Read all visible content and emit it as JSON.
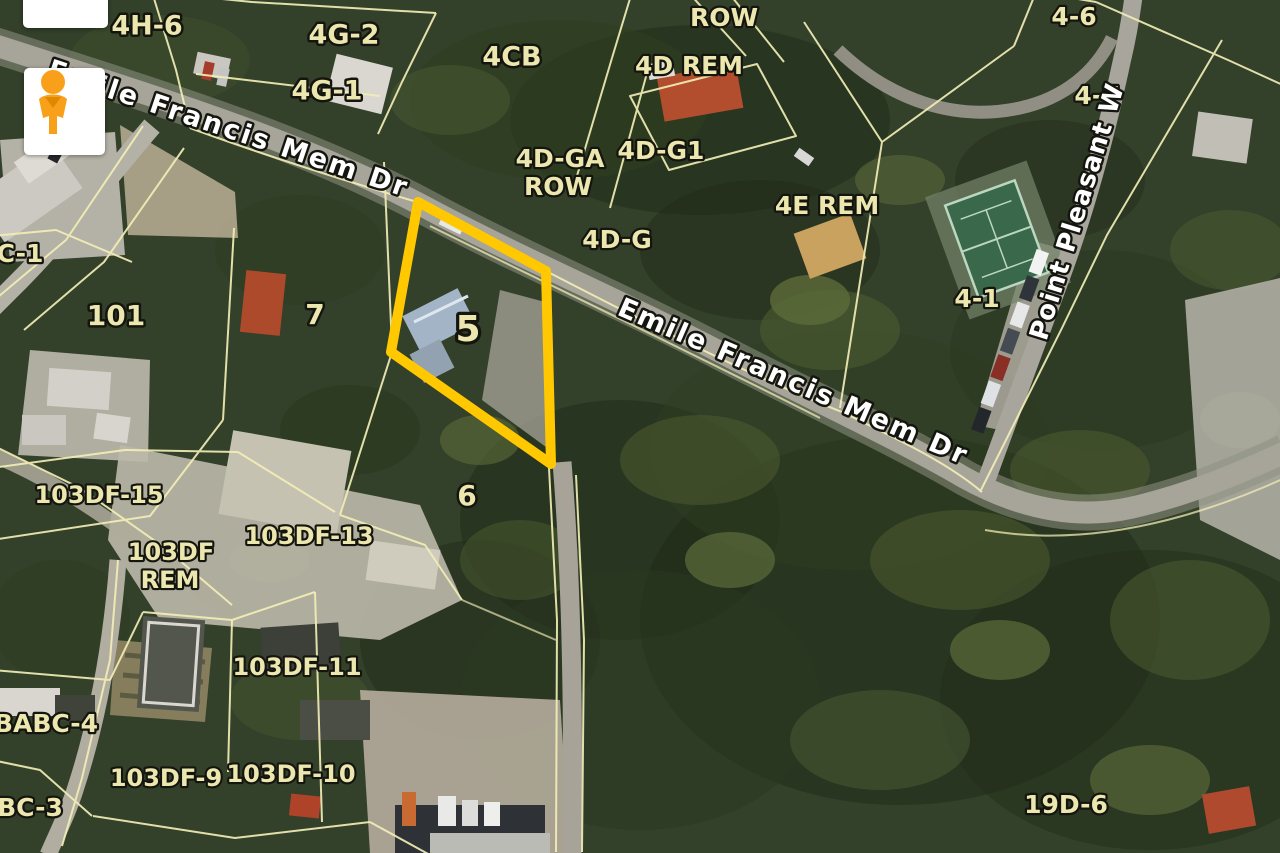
{
  "map": {
    "type": "aerial-parcel-map",
    "colors": {
      "parcel_line": "#f2eeb6",
      "parcel_label": "#ece7ae",
      "street_label": "#ffffff",
      "highlight": "#ffc800"
    },
    "highlight": {
      "parcel_id": "5",
      "vertices": [
        [
          418,
          202
        ],
        [
          546,
          271
        ],
        [
          551,
          464
        ],
        [
          391,
          352
        ]
      ],
      "stroke_width": 10
    },
    "labels": [
      {
        "text": "4H-6",
        "x": 147,
        "y": 27,
        "size": 27,
        "rot": 0,
        "kind": "parcel"
      },
      {
        "text": "4G-2",
        "x": 344,
        "y": 36,
        "size": 27,
        "rot": 0,
        "kind": "parcel"
      },
      {
        "text": "4G-1",
        "x": 327,
        "y": 92,
        "size": 27,
        "rot": 0,
        "kind": "parcel"
      },
      {
        "text": "4CB",
        "x": 512,
        "y": 58,
        "size": 27,
        "rot": 0,
        "kind": "parcel"
      },
      {
        "text": "ROW",
        "x": 724,
        "y": 19,
        "size": 25,
        "rot": 0,
        "kind": "parcel"
      },
      {
        "text": "4D REM",
        "x": 689,
        "y": 67,
        "size": 25,
        "rot": 0,
        "kind": "parcel"
      },
      {
        "text": "4D-GA",
        "x": 560,
        "y": 160,
        "size": 25,
        "rot": 0,
        "kind": "parcel"
      },
      {
        "text": "ROW",
        "x": 558,
        "y": 188,
        "size": 25,
        "rot": 0,
        "kind": "parcel"
      },
      {
        "text": "4D-G1",
        "x": 661,
        "y": 152,
        "size": 25,
        "rot": 0,
        "kind": "parcel"
      },
      {
        "text": "4D-G",
        "x": 617,
        "y": 241,
        "size": 25,
        "rot": 0,
        "kind": "parcel"
      },
      {
        "text": "4E REM",
        "x": 827,
        "y": 207,
        "size": 25,
        "rot": 0,
        "kind": "parcel"
      },
      {
        "text": "4-6",
        "x": 1074,
        "y": 18,
        "size": 25,
        "rot": 0,
        "kind": "parcel"
      },
      {
        "text": "4-7",
        "x": 1097,
        "y": 97,
        "size": 25,
        "rot": 0,
        "kind": "parcel"
      },
      {
        "text": "4-1",
        "x": 977,
        "y": 300,
        "size": 25,
        "rot": 0,
        "kind": "parcel"
      },
      {
        "text": "C-1",
        "x": 20,
        "y": 255,
        "size": 25,
        "rot": 0,
        "kind": "parcel"
      },
      {
        "text": "101",
        "x": 116,
        "y": 317,
        "size": 28,
        "rot": 0,
        "kind": "parcel"
      },
      {
        "text": "7",
        "x": 315,
        "y": 316,
        "size": 28,
        "rot": 0,
        "kind": "parcel"
      },
      {
        "text": "6",
        "x": 467,
        "y": 497,
        "size": 28,
        "rot": 0,
        "kind": "parcel"
      },
      {
        "text": "103DF-15",
        "x": 99,
        "y": 496,
        "size": 24,
        "rot": 0,
        "kind": "parcel"
      },
      {
        "text": "103DF",
        "x": 171,
        "y": 553,
        "size": 24,
        "rot": 0,
        "kind": "parcel"
      },
      {
        "text": "REM",
        "x": 170,
        "y": 581,
        "size": 24,
        "rot": 0,
        "kind": "parcel"
      },
      {
        "text": "103DF-13",
        "x": 309,
        "y": 537,
        "size": 24,
        "rot": 0,
        "kind": "parcel"
      },
      {
        "text": "103DF-11",
        "x": 297,
        "y": 668,
        "size": 24,
        "rot": 0,
        "kind": "parcel"
      },
      {
        "text": "BABC-4",
        "x": 46,
        "y": 725,
        "size": 25,
        "rot": 0,
        "kind": "parcel"
      },
      {
        "text": "103DF-9",
        "x": 166,
        "y": 779,
        "size": 24,
        "rot": 0,
        "kind": "parcel"
      },
      {
        "text": "103DF-10",
        "x": 291,
        "y": 775,
        "size": 24,
        "rot": 0,
        "kind": "parcel"
      },
      {
        "text": "BC-3",
        "x": 30,
        "y": 809,
        "size": 25,
        "rot": 0,
        "kind": "parcel"
      },
      {
        "text": "19D-6",
        "x": 1066,
        "y": 806,
        "size": 25,
        "rot": 0,
        "kind": "parcel"
      },
      {
        "text": "5",
        "x": 468,
        "y": 331,
        "size": 36,
        "rot": 0,
        "kind": "highlight-parcel"
      },
      {
        "text": "Emile Francis Mem Dr",
        "x": 228,
        "y": 130,
        "size": 27,
        "rot": 18.5,
        "ls": 2.5,
        "kind": "street"
      },
      {
        "text": "Emile Francis Mem Dr",
        "x": 793,
        "y": 383,
        "size": 27,
        "rot": 23.5,
        "ls": 2.5,
        "kind": "street"
      },
      {
        "text": "Point Pleasant W",
        "x": 1078,
        "y": 212,
        "size": 26,
        "rot": -73,
        "ls": 1,
        "kind": "street"
      }
    ]
  },
  "controls": {
    "pegman": {
      "icon": "pegman-icon",
      "color": "#f9a01b"
    },
    "collapsed_card": {
      "visible": true
    }
  }
}
